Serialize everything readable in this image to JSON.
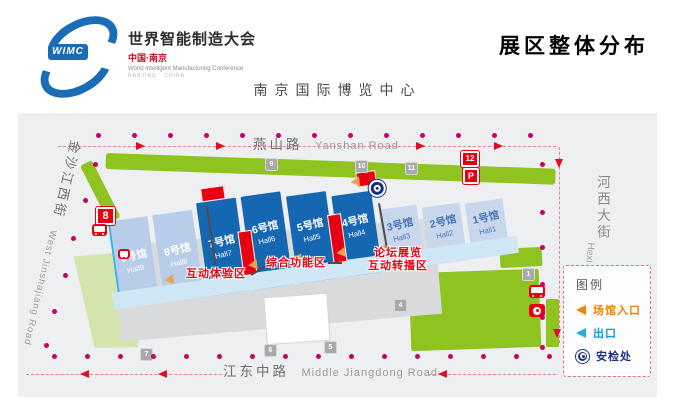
{
  "header": {
    "logo": {
      "acronym": "WIMC",
      "title": "世界智能制造大会",
      "location": "中国·南京",
      "subtitle": "World Intelligent Manufacturing Conference",
      "subtitle2": "NANJING · CHINA"
    },
    "title": "展区整体分布",
    "venue": "南京国际博览中心"
  },
  "map": {
    "roads": {
      "north": {
        "cn": "燕山路",
        "en": "Yanshan Road"
      },
      "south": {
        "cn": "江东中路",
        "en": "Middle Jiangdong Road"
      },
      "west": {
        "cn": "金沙江西街",
        "en": "West Jinshajiang Road"
      },
      "east": {
        "cn": "河西大街",
        "en": "Hexi Avenue"
      }
    },
    "halls": [
      {
        "cn": "9号馆",
        "en": "Hall9"
      },
      {
        "cn": "8号馆",
        "en": "Hall8"
      },
      {
        "cn": "7号馆",
        "en": "Hall7"
      },
      {
        "cn": "6号馆",
        "en": "Hall6"
      },
      {
        "cn": "5号馆",
        "en": "Hall5"
      },
      {
        "cn": "4号馆",
        "en": "Hall4"
      },
      {
        "cn": "3号馆",
        "en": "Hall3"
      },
      {
        "cn": "2号馆",
        "en": "Hall2"
      },
      {
        "cn": "1号馆",
        "en": "Hall1"
      }
    ],
    "zones": {
      "interactive": "互动体验区",
      "functional": "综合功能区",
      "forum_line1": "论坛展览",
      "forum_line2": "互动转播区"
    },
    "gates": {
      "g1": "1",
      "g4": "4",
      "g5": "5",
      "g6": "6",
      "g7": "7",
      "g8": "8",
      "g9": "9",
      "g10": "10",
      "g11": "11",
      "g12": "12",
      "parking": "P"
    },
    "legend": {
      "title": "图例",
      "items": [
        {
          "label": "场馆入口",
          "color": "#f08300"
        },
        {
          "label": "出口",
          "color": "#00a0e9"
        },
        {
          "label": "安检处",
          "color": "#1e2f7d"
        }
      ]
    }
  },
  "colors": {
    "hall_dark": "#1667b1",
    "hall_light": "#b8cde9",
    "hall_pale": "#c9d7ed",
    "green": "#8fc31f",
    "red": "#e60012",
    "route_magenta": "#c70067",
    "entrance_orange": "#eda14e",
    "exit_cyan": "#00a0e9",
    "security_navy": "#16327f"
  }
}
